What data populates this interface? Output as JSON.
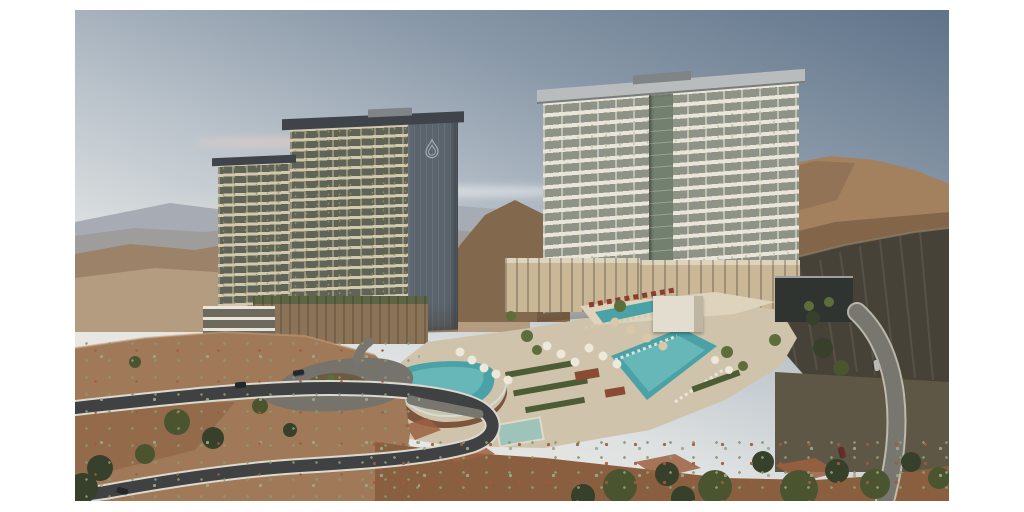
{
  "image": {
    "kind": "architectural rendering photograph",
    "description": "Aerial dusk view of a two-tower luxury desert resort on a mountainside with pool deck, switchback road and arid mountain backdrop, inset on a white frame",
    "frame": {
      "background": "#ffffff"
    },
    "elements": [
      "sky",
      "clouds",
      "distant mountains",
      "right mountain slope",
      "dark rock cliff",
      "left residential tower",
      "brand emblem on tower core",
      "right residential tower",
      "podium buildings",
      "white pavilion",
      "dark amenity building",
      "pool deck",
      "curved infinity pool",
      "main pool",
      "lap pool",
      "spa pool",
      "umbrellas",
      "loungers",
      "hedges",
      "palm trees",
      "trees",
      "arrival court",
      "switchback road",
      "right driveway",
      "cars",
      "desert shrubs",
      "boulders"
    ]
  },
  "palette": {
    "page_bg": "#ffffff",
    "sky_top": "#5f7389",
    "sky_upper": "#8a99a9",
    "sky_mid": "#b9c2ca",
    "sky_low": "#dfe2e2",
    "sky_horizon": "#f2ece1",
    "glow": "#f6e9d4",
    "cloud_pink": "#e9d2c9",
    "mtn_far": "#a7acb4",
    "mtn_far2": "#9c9a98",
    "mtn_mid": "#9b8268",
    "mtn_mid_dark": "#82684c",
    "valley": "#b49c80",
    "mtn_right_light": "#a3815f",
    "mtn_right": "#7b5f45",
    "cliff_dark": "#474238",
    "cliff_light": "#6b6257",
    "cliff_rim": "#8d7f68",
    "hill_fore": "#8a5f40",
    "hill_fore_light": "#a07a58",
    "hill_rim": "#c69d74",
    "rock_red": "#9c6040",
    "ground_dark": "#5e5746",
    "road_dark": "#3f4143",
    "road_edge": "#ddd9cf",
    "drive_gray": "#77766f",
    "drive_edge": "#cfcabc",
    "plaza_gray": "#75736b",
    "island_soil": "#6b5c41",
    "tower_l_slab": "#d3c7ad",
    "tower_l_band": "#5f6457",
    "tower_l_core": "#5b646d",
    "tower_l_roof": "#3f444a",
    "roof_equip": "#7f8486",
    "emblem": "#a9b2b8",
    "tower_r_slab": "#e9e5da",
    "tower_r_band": "#8f9287",
    "tower_r_roof": "#b9bcbc",
    "tower_r_glass": "#73806f",
    "podium_wall": "#8b7357",
    "podium_roof_green": "#5c6544",
    "podium_cream": "#c9b795",
    "pavilion_white": "#e3ddcf",
    "amenity_dark": "#2f3431",
    "deck": "#cfc3ab",
    "deck_light": "#ded4bd",
    "pool_teal": "#4aa2a6",
    "pool_light": "#7cc4c4",
    "pool_wall": "#7c553c",
    "pool_rim": "#cfe4de",
    "hedge_green": "#4c5c35",
    "planter_rust": "#8a4a33",
    "umbrella_white": "#eee8da",
    "umbrella_tan": "#d8c8a8",
    "lounger_red": "#8e3b30",
    "tree_green": "#4a5530",
    "tree_dark": "#36402a",
    "palm_green": "#5d6e3c",
    "shrub_sage": "#8a9a74",
    "shrub_red": "#a05a3e",
    "agave": "#9cab8d",
    "car_dark": "#23262a",
    "car_silver": "#b9b9b6",
    "car_red": "#6b2a24"
  }
}
